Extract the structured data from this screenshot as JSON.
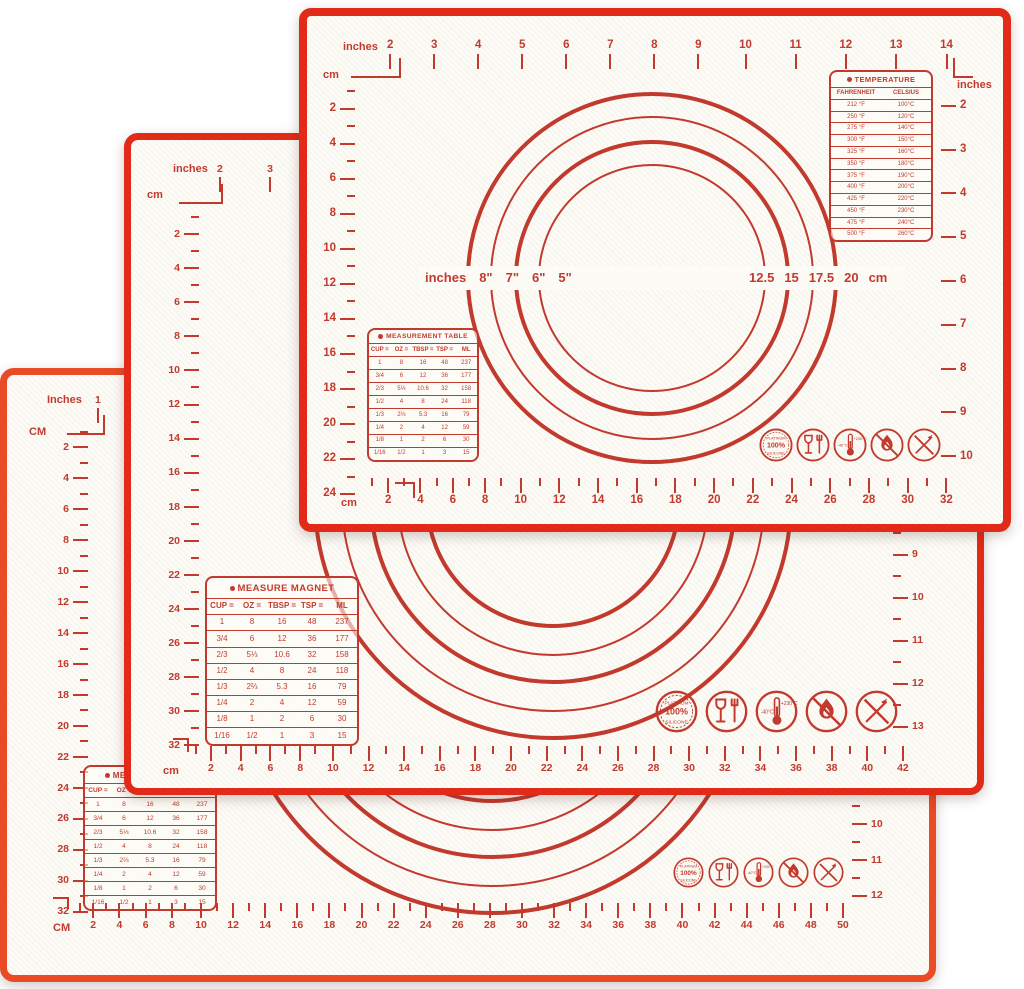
{
  "colors": {
    "ink": "#c23a2e",
    "border_red": "#e22a18",
    "bottom_mat_border": "#e84b25",
    "mat_background": "#fdfbf6"
  },
  "icons": {
    "badge_line1": "PLATINUM",
    "badge_line2": "100%",
    "badge_line3": "SILICONE",
    "thermo_min": "-40°C",
    "thermo_max": "+230°C"
  },
  "tables": {
    "temperature": {
      "title": "TEMPERATURE",
      "header": [
        "FAHRENHEIT",
        "CELSIUS"
      ],
      "rows": [
        [
          "212 °F",
          "100°C"
        ],
        [
          "250 °F",
          "120°C"
        ],
        [
          "275 °F",
          "140°C"
        ],
        [
          "300 °F",
          "150°C"
        ],
        [
          "325 °F",
          "160°C"
        ],
        [
          "350 °F",
          "180°C"
        ],
        [
          "375 °F",
          "190°C"
        ],
        [
          "400 °F",
          "200°C"
        ],
        [
          "425 °F",
          "220°C"
        ],
        [
          "450 °F",
          "230°C"
        ],
        [
          "475 °F",
          "240°C"
        ],
        [
          "500 °F",
          "260°C"
        ]
      ]
    },
    "measurement": {
      "title": "MEASUREMENT TABLE",
      "header": [
        "CUP =",
        "OZ =",
        "TBSP =",
        "TSP =",
        "ML"
      ],
      "rows": [
        [
          "1",
          "8",
          "16",
          "48",
          "237"
        ],
        [
          "3/4",
          "6",
          "12",
          "36",
          "177"
        ],
        [
          "2/3",
          "5⅓",
          "10.6",
          "32",
          "158"
        ],
        [
          "1/2",
          "4",
          "8",
          "24",
          "118"
        ],
        [
          "1/3",
          "2⅔",
          "5.3",
          "16",
          "79"
        ],
        [
          "1/4",
          "2",
          "4",
          "12",
          "59"
        ],
        [
          "1/8",
          "1",
          "2",
          "6",
          "30"
        ],
        [
          "1/16",
          "1/2",
          "1",
          "3",
          "15"
        ]
      ]
    },
    "measure_magnet": {
      "title": "MEASURE MAGNET",
      "header": [
        "CUP =",
        "OZ =",
        "TBSP =",
        "TSP =",
        "ML"
      ],
      "rows": [
        [
          "1",
          "8",
          "16",
          "48",
          "237"
        ],
        [
          "3/4",
          "6",
          "12",
          "36",
          "177"
        ],
        [
          "2/3",
          "5⅓",
          "10.6",
          "32",
          "158"
        ],
        [
          "1/2",
          "4",
          "8",
          "24",
          "118"
        ],
        [
          "1/3",
          "2⅔",
          "5.3",
          "16",
          "79"
        ],
        [
          "1/4",
          "2",
          "4",
          "12",
          "59"
        ],
        [
          "1/8",
          "1",
          "2",
          "6",
          "30"
        ],
        [
          "1/16",
          "1/2",
          "1",
          "3",
          "15"
        ]
      ]
    }
  },
  "mats": {
    "top": {
      "units": {
        "top": "inches",
        "cm_corner": "cm",
        "top_right": "inches",
        "bottom": "cm"
      },
      "top_ruler": [
        2,
        3,
        4,
        5,
        6,
        7,
        8,
        9,
        10,
        11,
        12,
        13,
        14
      ],
      "left_ruler": [
        2,
        4,
        6,
        8,
        10,
        12,
        14,
        16,
        18,
        20,
        22,
        24
      ],
      "right_ruler": [
        2,
        3,
        4,
        5,
        6,
        7,
        8,
        9,
        10
      ],
      "bottom_ruler": [
        2,
        4,
        6,
        8,
        10,
        12,
        14,
        16,
        18,
        20,
        22,
        24,
        26,
        28,
        30,
        32
      ],
      "circle_labels": {
        "left_unit": "inches",
        "left": [
          "8\"",
          "7\"",
          "6\"",
          "5\""
        ],
        "right": [
          "12.5",
          "15",
          "17.5",
          "20"
        ],
        "right_unit": "cm"
      }
    },
    "middle": {
      "units": {
        "top": "inches",
        "cm_corner": "cm",
        "bottom": "cm"
      },
      "top_ruler": [
        2,
        3
      ],
      "left_ruler": [
        2,
        4,
        6,
        8,
        10,
        12,
        14,
        16,
        18,
        20,
        22,
        24,
        26,
        28,
        30,
        32
      ],
      "right_ruler": [
        9,
        10,
        11,
        12,
        13
      ],
      "bottom_ruler": [
        2,
        4,
        6,
        8,
        10,
        12,
        14,
        16,
        18,
        20,
        22,
        24,
        26,
        28,
        30,
        32,
        34,
        36,
        38,
        40,
        42
      ]
    },
    "bottom": {
      "units": {
        "top": "Inches",
        "cm_corner": "CM",
        "bottom": "CM"
      },
      "top_ruler": [
        1
      ],
      "left_ruler": [
        2,
        4,
        6,
        8,
        10,
        12,
        14,
        16,
        18,
        20,
        22,
        24,
        26,
        28,
        30,
        32
      ],
      "right_ruler": [
        10,
        11,
        12
      ],
      "bottom_ruler": [
        2,
        4,
        6,
        8,
        10,
        12,
        14,
        16,
        18,
        20,
        22,
        24,
        26,
        28,
        30,
        32,
        34,
        36,
        38,
        40,
        42,
        44,
        46,
        48,
        50
      ]
    }
  }
}
